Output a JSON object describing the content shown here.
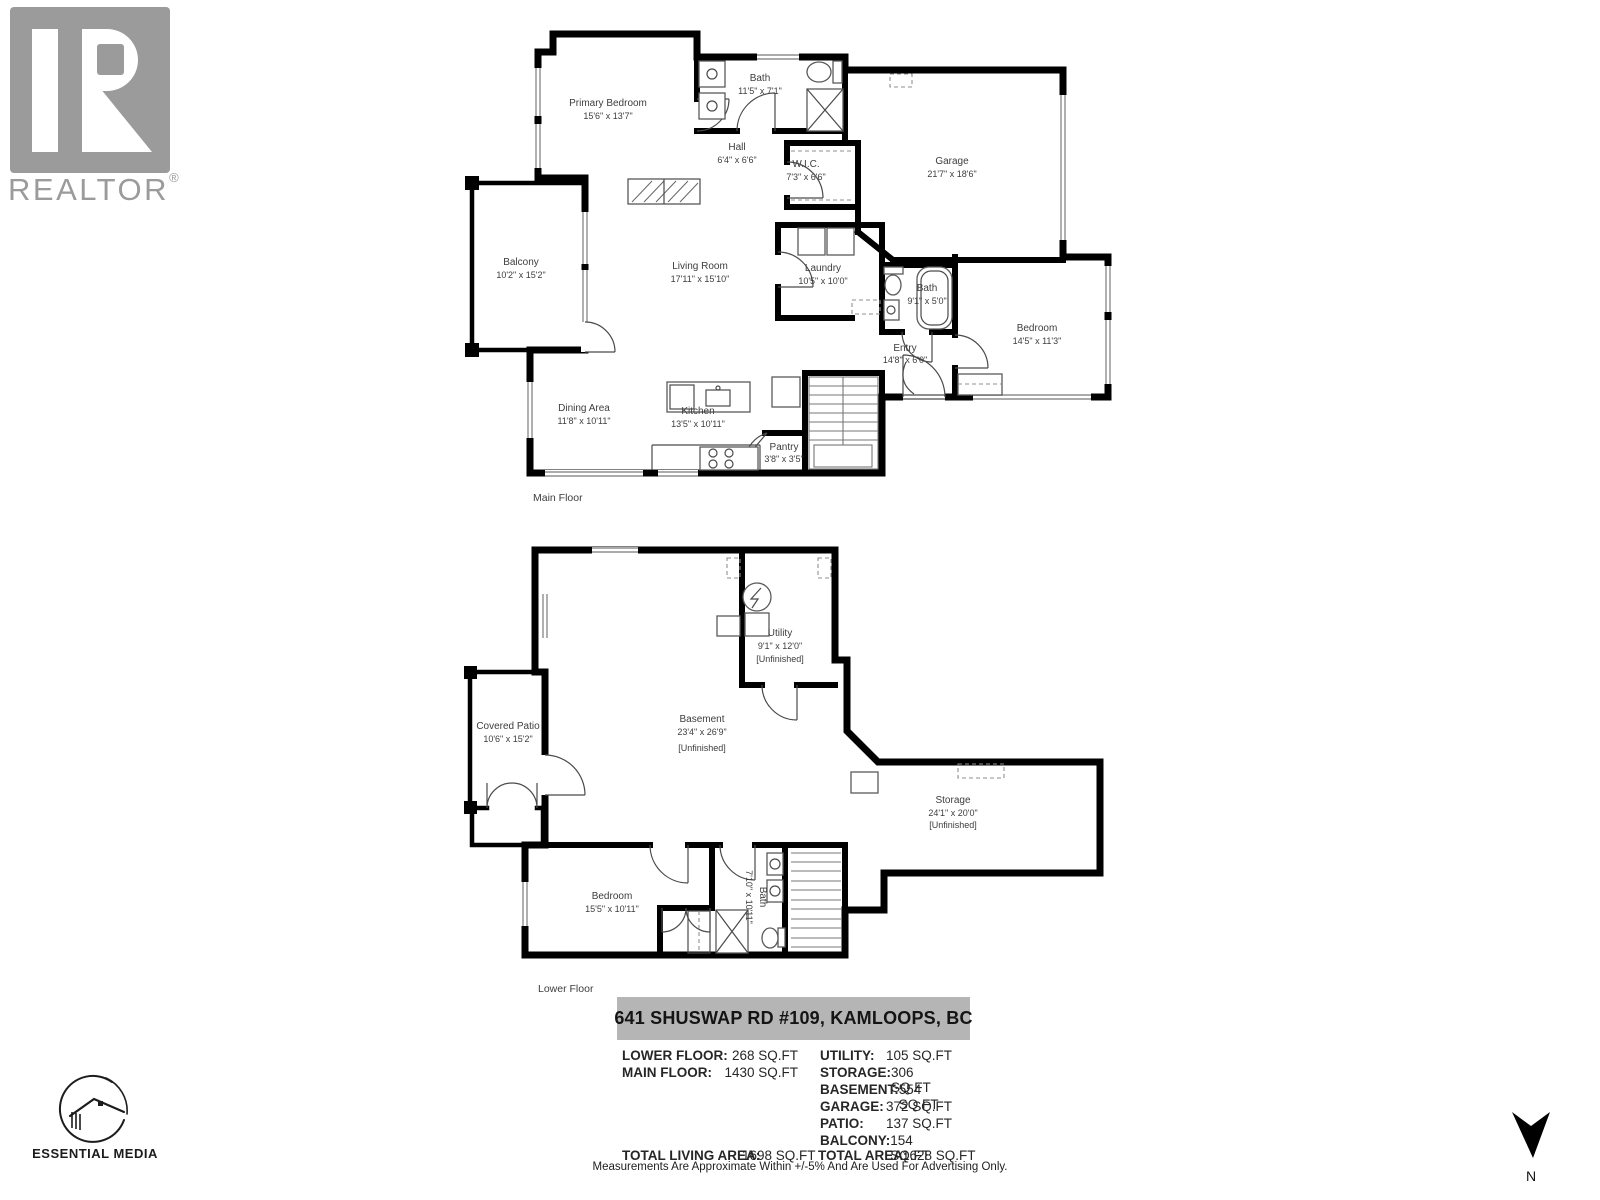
{
  "branding": {
    "realtor_wordmark": "REALTOR",
    "registered_mark": "®",
    "media_credit": "ESSENTIAL MEDIA"
  },
  "compass": {
    "north_label": "N"
  },
  "floors": [
    {
      "caption": "Main Floor",
      "rooms": [
        {
          "label": "Primary Bedroom",
          "dims": "15'6\" x 13'7\""
        },
        {
          "label": "Bath",
          "dims": "11'5\" x 7'1\""
        },
        {
          "label": "Hall",
          "dims": "6'4\" x 6'6\""
        },
        {
          "label": "W.I.C.",
          "dims": "7'3\" x 6'6\""
        },
        {
          "label": "Garage",
          "dims": "21'7\" x 18'6\""
        },
        {
          "label": "Balcony",
          "dims": "10'2\" x 15'2\""
        },
        {
          "label": "Living Room",
          "dims": "17'11\" x 15'10\""
        },
        {
          "label": "Laundry",
          "dims": "10'5\" x 10'0\""
        },
        {
          "label": "Bath",
          "dims": "9'1\" x 5'0\""
        },
        {
          "label": "Bedroom",
          "dims": "14'5\" x 11'3\""
        },
        {
          "label": "Entry",
          "dims": "14'8\" x 6'0\""
        },
        {
          "label": "Dining Area",
          "dims": "11'8\" x 10'11\""
        },
        {
          "label": "Kitchen",
          "dims": "13'5\" x 10'11\""
        },
        {
          "label": "Pantry",
          "dims": "3'8\" x 3'5\""
        }
      ]
    },
    {
      "caption": "Lower Floor",
      "rooms": [
        {
          "label": "Utility",
          "dims": "9'1\" x 12'0\"",
          "note": "[Unfinished]"
        },
        {
          "label": "Covered Patio",
          "dims": "10'6\" x 15'2\""
        },
        {
          "label": "Basement",
          "dims": "23'4\" x 26'9\"",
          "note": "[Unfinished]"
        },
        {
          "label": "Storage",
          "dims": "24'1\" x 20'0\"",
          "note": "[Unfinished]"
        },
        {
          "label": "Bedroom",
          "dims": "15'5\" x 10'11\""
        },
        {
          "label": "Bath",
          "dims": "7'10\" x 10'11\""
        }
      ]
    }
  ],
  "summary": {
    "address": "641 SHUSWAP RD #109, KAMLOOPS, BC",
    "area_rows_left": [
      {
        "label": "LOWER FLOOR:",
        "value": "268 SQ.FT"
      },
      {
        "label": "MAIN FLOOR:",
        "value": "1430 SQ.FT"
      }
    ],
    "area_rows_right": [
      {
        "label": "UTILITY:",
        "value": "105 SQ.FT"
      },
      {
        "label": "STORAGE:",
        "value": "306 SQ.FT"
      },
      {
        "label": "BASEMENT:",
        "value": "554 SQ.FT"
      },
      {
        "label": "GARAGE:",
        "value": "372 SQ.FT"
      },
      {
        "label": "PATIO:",
        "value": "137 SQ.FT"
      },
      {
        "label": "BALCONY:",
        "value": "154 SQ.FT"
      }
    ],
    "totals": [
      {
        "label": "TOTAL LIVING AREA:",
        "value": "1698 SQ.FT"
      },
      {
        "label": "TOTAL AREA:",
        "value": "1628 SQ.FT"
      }
    ],
    "disclaimer": "Measurements Are Approximate Within +/-5% And Are Used For Advertising Only."
  },
  "colors": {
    "wall": "#000000",
    "label_text": "#3d3d3d",
    "banner_bg": "#b5b5b5",
    "logo_gray": "#9b9b9b"
  }
}
